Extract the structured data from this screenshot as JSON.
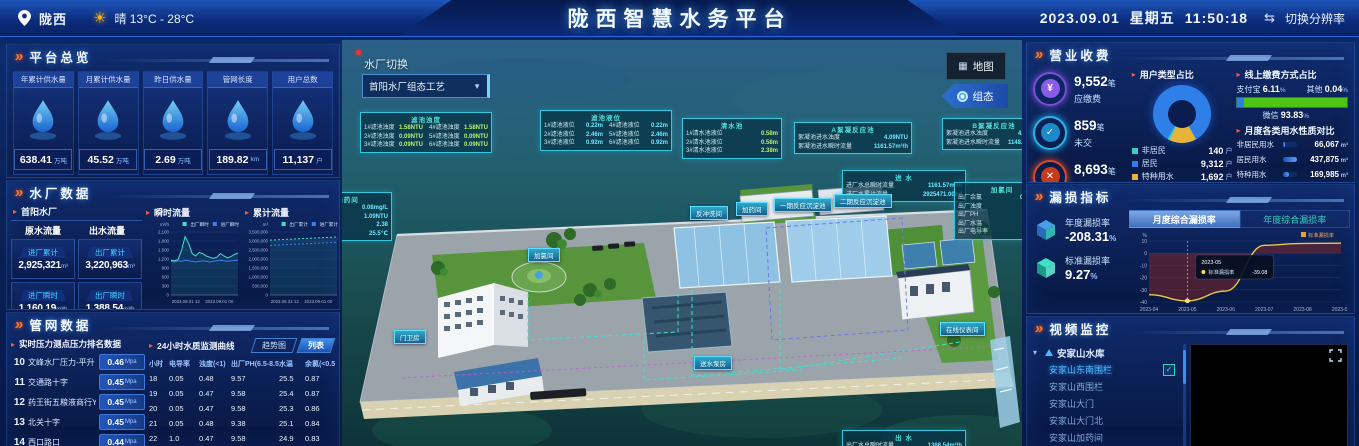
{
  "header": {
    "location": "陇西",
    "weather": "晴  13°C - 28°C",
    "title": "陇西智慧水务平台",
    "date": "2023.09.01",
    "weekday": "星期五",
    "time": "11:50:18",
    "resolution_switch": "切换分辨率"
  },
  "overview": {
    "section_title": "平台总览",
    "cards": [
      {
        "label": "年累计供水量",
        "value": "638.41",
        "unit": "万吨",
        "icon": "water-drop-icon"
      },
      {
        "label": "月累计供水量",
        "value": "45.52",
        "unit": "万吨",
        "icon": "water-drop-icon"
      },
      {
        "label": "昨日供水量",
        "value": "2.69",
        "unit": "万吨",
        "icon": "water-drop-icon"
      },
      {
        "label": "管网长度",
        "value": "189.82",
        "unit": "km",
        "icon": "pipeline-icon"
      },
      {
        "label": "用户总数",
        "value": "11,137",
        "unit": "户",
        "icon": "users-icon"
      }
    ]
  },
  "plant": {
    "section_title": "水厂数据",
    "plant_name": "首阳水厂",
    "col1_header": "原水流量",
    "col2_header": "出水流量",
    "stats": [
      {
        "label": "进厂累计",
        "value": "2,925,321",
        "unit": "m³"
      },
      {
        "label": "出厂累计",
        "value": "3,220,963",
        "unit": "m³"
      },
      {
        "label": "进厂瞬时",
        "value": "1,160.19",
        "unit": "m³/h"
      },
      {
        "label": "出厂瞬时",
        "value": "1,388.54",
        "unit": "m³/h"
      }
    ],
    "chart1_title": "瞬时流量",
    "chart2_title": "累计流量"
  },
  "network": {
    "section_title": "管网数据",
    "pressure": {
      "title": "实时压力测点压力排名数据",
      "rows": [
        {
          "rank": "10",
          "name": "文峰水厂压力-平升",
          "value": "0.46",
          "unit": "Mpa"
        },
        {
          "rank": "11",
          "name": "交通路十字",
          "value": "0.45",
          "unit": "Mpa"
        },
        {
          "rank": "12",
          "name": "药王街五粮液商行YT",
          "value": "0.45",
          "unit": "Mpa"
        },
        {
          "rank": "13",
          "name": "北关十字",
          "value": "0.45",
          "unit": "Mpa"
        },
        {
          "rank": "14",
          "name": "西口路口",
          "value": "0.44",
          "unit": "Mpa"
        }
      ]
    },
    "quality": {
      "title": "24小时水质监测曲线",
      "tab_trend": "趋势图",
      "tab_list": "列表",
      "headers": [
        "小时",
        "电导率",
        "浊度(<1)",
        "出厂PH(6.5-8.5)",
        "水温",
        "余氯(<0.5)"
      ],
      "rows": [
        [
          "18",
          "0.05",
          "0.48",
          "9.57",
          "25.5",
          "0.87"
        ],
        [
          "19",
          "0.05",
          "0.47",
          "9.58",
          "25.4",
          "0.87"
        ],
        [
          "20",
          "0.05",
          "0.47",
          "9.58",
          "25.3",
          "0.86"
        ],
        [
          "21",
          "0.05",
          "0.48",
          "9.38",
          "25.1",
          "0.84"
        ],
        [
          "22",
          "1.0",
          "0.47",
          "9.58",
          "24.9",
          "0.83"
        ],
        [
          "23",
          "0.05",
          "0.47",
          "9.59",
          "24.8",
          "0.82"
        ]
      ]
    }
  },
  "scene": {
    "switch_label": "水厂切换",
    "switch_value": "首阳水厂组态工艺",
    "map_button": "地图",
    "config_button": "组态",
    "panels": [
      {
        "title": "滤池浊度",
        "x": 18,
        "y": 72,
        "w": 124,
        "cols": 2,
        "value_color": "#b8f06a",
        "rows": [
          [
            "1#滤池浊度",
            "1.58NTU"
          ],
          [
            "2#滤池浊度",
            "0.09NTU"
          ],
          [
            "3#滤池浊度",
            "0.09NTU"
          ],
          [
            "4#滤池浊度",
            "1.58NTU"
          ],
          [
            "5#滤池浊度",
            "0.09NTU"
          ],
          [
            "6#滤池浊度",
            "0.09NTU"
          ]
        ]
      },
      {
        "title": "滤池液位",
        "x": 198,
        "y": 70,
        "w": 124,
        "cols": 2,
        "value_color": "#6ee7ff",
        "rows": [
          [
            "1#滤池液位",
            "0.22m"
          ],
          [
            "2#滤池液位",
            "2.46m"
          ],
          [
            "3#滤池液位",
            "0.92m"
          ],
          [
            "4#滤池液位",
            "0.22m"
          ],
          [
            "5#滤池液位",
            "2.46m"
          ],
          [
            "6#滤池液位",
            "0.92m"
          ]
        ]
      },
      {
        "title": "清水池",
        "x": 340,
        "y": 78,
        "w": 92,
        "cols": 1,
        "value_color": "#b8f06a",
        "rows": [
          [
            "1#清水池液位",
            "0.58m"
          ],
          [
            "2#清水池液位",
            "0.58m"
          ],
          [
            "3#清水池液位",
            "2.38m"
          ]
        ]
      },
      {
        "title": "A絮凝反应池",
        "x": 452,
        "y": 82,
        "w": 110,
        "cols": 1,
        "value_color": "#6ee7ff",
        "rows": [
          [
            "絮凝池进水浊度",
            "4.09NTU"
          ],
          [
            "絮凝池进水瞬时流量",
            "1161.57m³/h"
          ]
        ]
      },
      {
        "title": "B絮凝反应池",
        "x": 600,
        "y": 78,
        "w": 96,
        "cols": 1,
        "value_color": "#6ee7ff",
        "rows": [
          [
            "絮凝池进水浊度",
            "4.09NTU"
          ],
          [
            "絮凝池进水瞬时流量",
            "1148.30m³/h"
          ]
        ]
      },
      {
        "title": "进 水",
        "x": 500,
        "y": 130,
        "w": 116,
        "cols": 1,
        "value_color": "#6ee7ff",
        "rows": [
          [
            "进厂水总瞬时流量",
            "1161.57m³/h"
          ],
          [
            "进厂水累计流量",
            "2925471.00m³"
          ]
        ]
      },
      {
        "title": "加氯间",
        "x": 612,
        "y": 142,
        "w": 88,
        "cols": 1,
        "value_color": "#6ee7ff",
        "rows": [
          [
            "出厂余氯",
            "0.08mg/L"
          ],
          [
            "出厂浊度",
            "1.09NTU"
          ],
          [
            "出厂PH",
            "9.57"
          ],
          [
            "出厂水温",
            "25.5℃"
          ],
          [
            "出厂电导率",
            "0.05"
          ]
        ]
      },
      {
        "title": "加氯加药间",
        "x": -54,
        "y": 152,
        "w": 96,
        "cols": 1,
        "value_color": "#6ee7ff",
        "rows": [
          [
            "出厂余氯",
            "0.08mg/L"
          ],
          [
            "出厂浊度",
            "1.09NTU"
          ],
          [
            "出厂PH",
            "2.38"
          ],
          [
            "水温",
            "25.5℃"
          ]
        ]
      },
      {
        "title": "出 水",
        "x": 500,
        "y": 390,
        "w": 116,
        "cols": 1,
        "value_color": "#6ee7ff",
        "rows": [
          [
            "出厂水总瞬时流量",
            "1388.54m³/h"
          ],
          [
            "出厂水累计流量",
            "3221454.00m³"
          ]
        ]
      }
    ],
    "tags": [
      {
        "label": "加氯间",
        "x": 186,
        "y": 208
      },
      {
        "label": "门卫房",
        "x": 52,
        "y": 290
      },
      {
        "label": "反冲洗间",
        "x": 348,
        "y": 166
      },
      {
        "label": "加药间",
        "x": 394,
        "y": 162
      },
      {
        "label": "一期反应沉淀池",
        "x": 432,
        "y": 158
      },
      {
        "label": "二期反应沉淀池",
        "x": 492,
        "y": 154
      },
      {
        "label": "送水泵房",
        "x": 352,
        "y": 316
      },
      {
        "label": "在线仪表间",
        "x": 598,
        "y": 282
      }
    ]
  },
  "billing": {
    "section_title": "营业收费",
    "stats": [
      {
        "value": "9,552",
        "unit": "笔",
        "label": "应缴费",
        "ring": "#7a4fd8",
        "fill": "#8a5ce8",
        "glyph": "¥"
      },
      {
        "value": "859",
        "unit": "笔",
        "label": "未交",
        "ring": "#2ab4e8",
        "fill": "#1a8ac8",
        "glyph": "✓"
      },
      {
        "value": "8,693",
        "unit": "笔",
        "label": "已交",
        "ring": "#d84a2a",
        "fill": "#c83a1a",
        "glyph": "✕"
      }
    ],
    "user_type": {
      "title": "用户类型占比",
      "legend": [
        {
          "label": "非居民",
          "value": "140",
          "unit": "户",
          "color": "#35d0c0"
        },
        {
          "label": "居民",
          "value": "9,312",
          "unit": "户",
          "color": "#2e7fe8"
        },
        {
          "label": "特种用水",
          "value": "1,692",
          "unit": "户",
          "color": "#e8b339"
        }
      ]
    },
    "payment": {
      "title": "线上缴费方式占比",
      "items": [
        {
          "label": "支付宝",
          "value": "6.11",
          "unit": "%"
        },
        {
          "label": "其他",
          "value": "0.04",
          "unit": "%"
        },
        {
          "label": "微信",
          "value": "93.83",
          "unit": "%"
        }
      ]
    },
    "monthly": {
      "title": "月度各类用水性质对比",
      "rows": [
        {
          "label": "非居民用水",
          "value": "66,067",
          "unit": "m³"
        },
        {
          "label": "居民用水",
          "value": "437,875",
          "unit": "m³"
        },
        {
          "label": "特种用水",
          "value": "169,985",
          "unit": "m³"
        }
      ]
    }
  },
  "leakage": {
    "section_title": "漏损指标",
    "annual_label": "年度漏损率",
    "annual_value": "-208.31",
    "standard_label": "标准漏损率",
    "standard_value": "9.27",
    "tab_month": "月度综合漏损率",
    "tab_year": "年度综合漏损率"
  },
  "video": {
    "section_title": "视频监控",
    "tree": [
      {
        "label": "安家山水库",
        "type": "group"
      },
      {
        "label": "安家山东南围栏",
        "type": "child",
        "selected": true
      },
      {
        "label": "安家山西围栏",
        "type": "child"
      },
      {
        "label": "安家山大门",
        "type": "child"
      },
      {
        "label": "安家山大门北",
        "type": "child"
      },
      {
        "label": "安家山加药间",
        "type": "child"
      },
      {
        "label": "首阳水厂",
        "type": "group"
      }
    ]
  },
  "chart_data": [
    {
      "id": "flow",
      "type": "line",
      "title": "瞬时流量",
      "unit": "m³/h",
      "ylim": [
        0,
        2100
      ],
      "yticks": [
        "2,100",
        "1,800",
        "1,500",
        "1,200",
        "900",
        "600",
        "300",
        "0"
      ],
      "xticks": [
        "2023.08.31 12",
        "2023.09.01 00"
      ],
      "grid": true,
      "legend_position": "top-right",
      "series": [
        {
          "name": "出厂瞬时",
          "color": "#3fe0c8",
          "values": [
            1160,
            1140,
            1180,
            1500,
            1950,
            1720,
            1380,
            1300,
            1420,
            1380,
            1300,
            1260,
            1220,
            1260,
            1380,
            1300,
            1240,
            1280,
            1350,
            1400
          ]
        },
        {
          "name": "进厂瞬时",
          "color": "#3b7ff0",
          "values": [
            1120,
            1100,
            1140,
            1120,
            1160,
            1140,
            1120,
            1100,
            1120,
            1140,
            1120,
            1100,
            1120,
            1140,
            1160,
            1140,
            1120,
            1140,
            1150,
            1160
          ]
        }
      ]
    },
    {
      "id": "cumulative",
      "type": "line",
      "title": "累计流量",
      "unit": "m³",
      "ylim": [
        0,
        3500000
      ],
      "yticks": [
        "3,500,000",
        "3,000,000",
        "2,500,000",
        "2,000,000",
        "1,500,000",
        "1,000,000",
        "500,000",
        "0"
      ],
      "xticks": [
        "2023.08.31 12",
        "2023.09.01 00"
      ],
      "grid": true,
      "dashed": true,
      "legend_position": "top-right",
      "series": [
        {
          "name": "出厂累计",
          "color": "#3fe0c8",
          "values": [
            3050000,
            3069000,
            3088000,
            3107000,
            3126000,
            3145000,
            3164000,
            3183000,
            3202000,
            3220963
          ]
        },
        {
          "name": "进厂累计",
          "color": "#3b7ff0",
          "values": [
            2760000,
            2778000,
            2796000,
            2815000,
            2833000,
            2851000,
            2870000,
            2888000,
            2906000,
            2925321
          ]
        }
      ]
    },
    {
      "id": "user-type-donut",
      "type": "pie",
      "title": "用户类型占比",
      "categories": [
        "非居民",
        "居民",
        "特种用水"
      ],
      "values": [
        140,
        9312,
        1692
      ],
      "colors": [
        "#35d0c0",
        "#2e7fe8",
        "#e8b339"
      ]
    },
    {
      "id": "payment-bar",
      "type": "bar",
      "title": "线上缴费方式占比",
      "categories": [
        "支付宝",
        "其他",
        "微信"
      ],
      "values": [
        6.11,
        0.04,
        93.83
      ],
      "colors": [
        "#2e7fe8",
        "#2e7fe8",
        "#4ec414"
      ]
    },
    {
      "id": "monthly-usage",
      "type": "bar",
      "title": "月度各类用水性质对比",
      "categories": [
        "非居民用水",
        "居民用水",
        "特种用水"
      ],
      "values": [
        66067,
        437875,
        169985
      ],
      "unit": "m³"
    },
    {
      "id": "leak",
      "type": "line",
      "title": "月度综合漏损率",
      "unit": "%",
      "ylim": [
        -40,
        10
      ],
      "yticks": [
        10,
        0,
        -10,
        -20,
        -30,
        -40
      ],
      "x": [
        "2023-04",
        "2023-05",
        "2023-06",
        "2023-07",
        "2023-08",
        "2023-09"
      ],
      "series": [
        {
          "name": "标准漏损率",
          "color": "#e8c84a",
          "values": [
            -34,
            -39.08,
            -31,
            6.5,
            8,
            8.2
          ]
        }
      ],
      "tooltip": {
        "x": "2023-05",
        "label": "标准漏损率",
        "value": "-39.08"
      },
      "legend_position": "top-right",
      "fill_color": "rgba(150,40,30,0.45)"
    }
  ],
  "colors": {
    "accent_teal": "#35d0c0",
    "accent_blue": "#2e7fe8",
    "accent_green": "#4ec414",
    "accent_orange": "#e8b339",
    "header_bg": "#0c2d7e",
    "panel_border": "#4682e6"
  }
}
